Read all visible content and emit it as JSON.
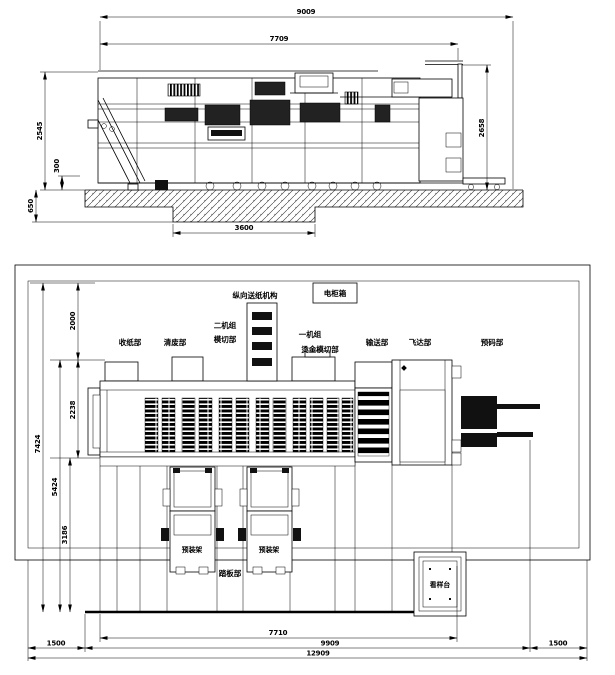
{
  "sheet": {
    "background": "#ffffff",
    "line_color": "#000000"
  },
  "top_view": {
    "dims": {
      "overall_length": "9009",
      "frame_length": "7709",
      "left_height": "2545",
      "base_offset": "300",
      "foundation_depth": "650",
      "right_height": "2658",
      "pit_width": "3600"
    }
  },
  "plan_view": {
    "dims": {
      "total_depth": "7424",
      "front_depth": "5424",
      "apron_depth": "3186",
      "body_depth": "2238",
      "rear_clearance": "2000",
      "body_length": "7710",
      "machine_length": "9909",
      "total_length": "12909",
      "left_clearance": "1500",
      "right_clearance": "1500"
    },
    "labels": {
      "longitudinal_feed": "纵向送纸机构",
      "electric_cabinet": "电柜箱",
      "delivery": "收纸部",
      "stripping": "清废部",
      "unit2_name": "二机组",
      "unit2_func": "模切部",
      "unit1_name": "一机组",
      "unit1_func": "烫金模切部",
      "conveyor": "输送部",
      "feeder": "飞达部",
      "prestack": "预码部",
      "precart_1": "预装架",
      "precart_2": "预装架",
      "footboard": "踏板部",
      "sample_table": "看样台"
    }
  }
}
